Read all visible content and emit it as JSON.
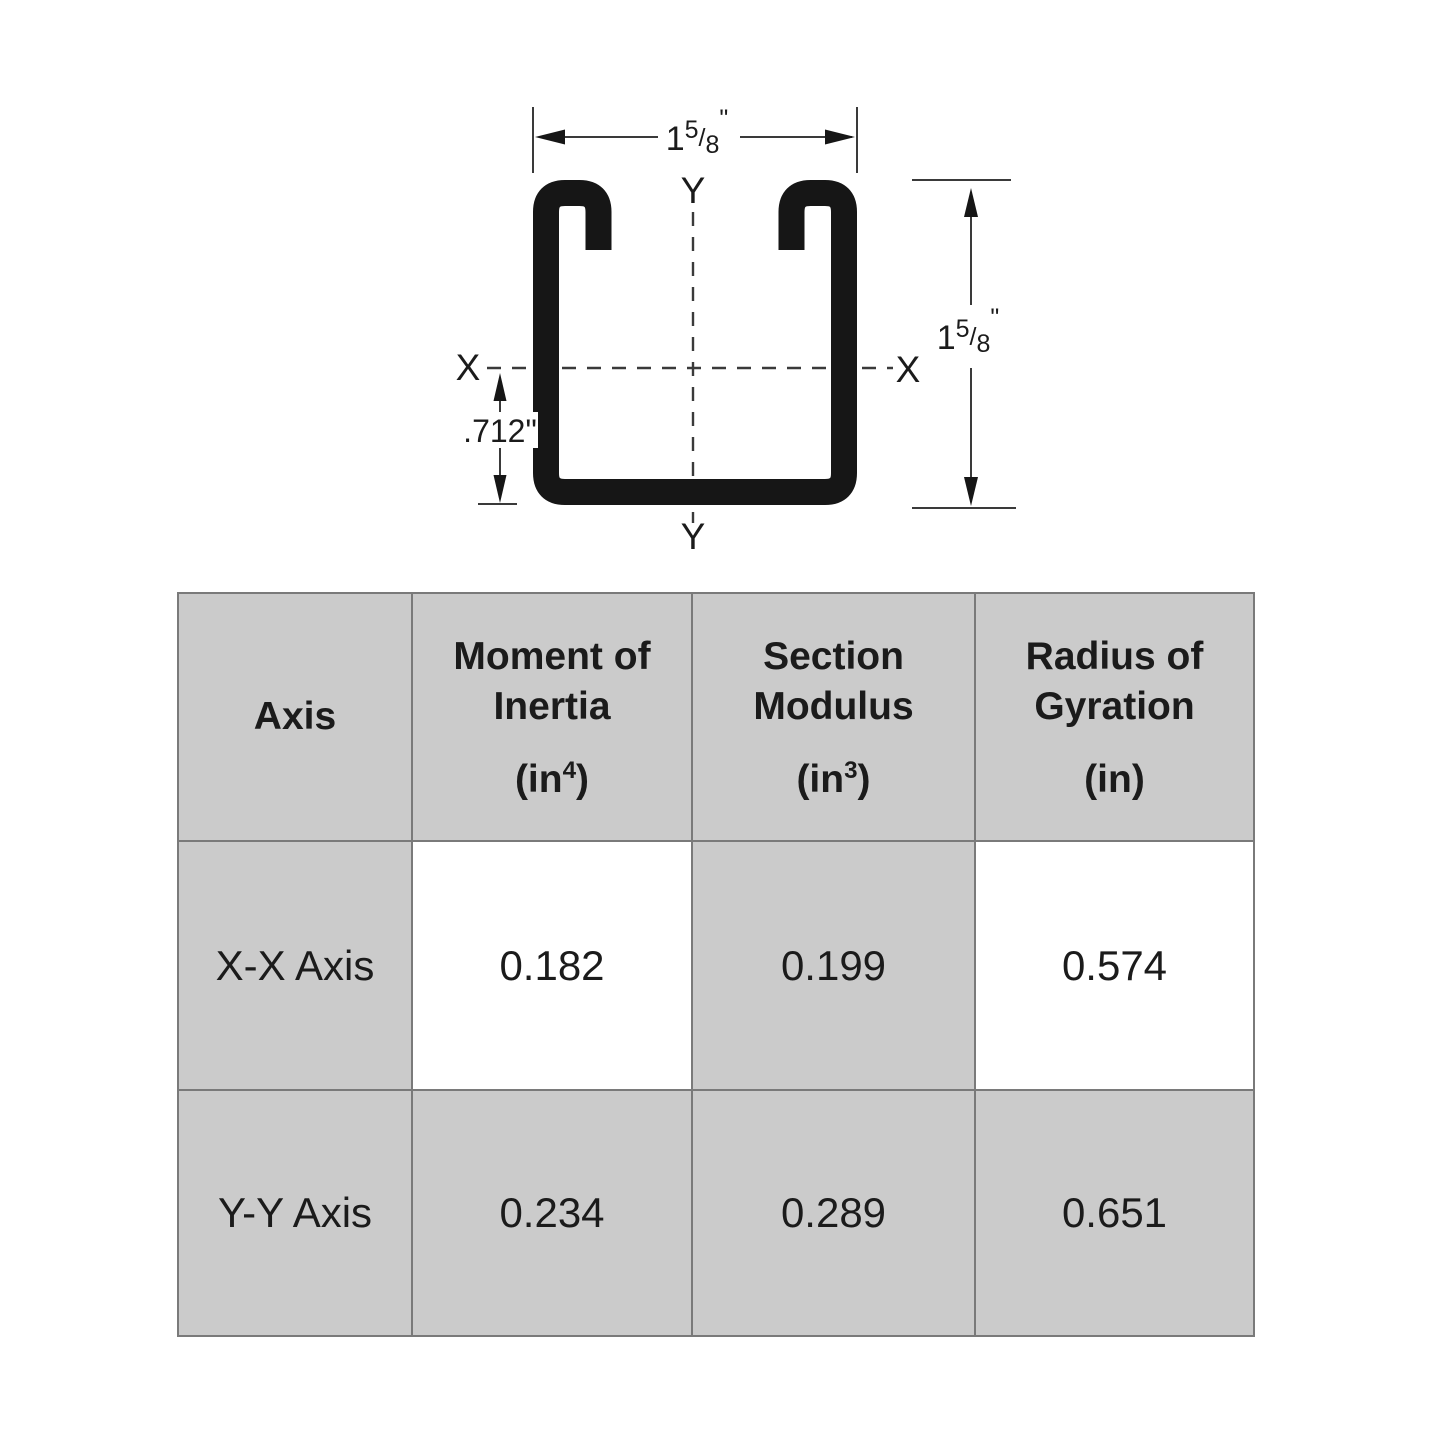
{
  "diagram": {
    "width_dim": {
      "whole": "1",
      "numerator": "5",
      "slash": "/",
      "denominator": "8",
      "unit": "\""
    },
    "height_dim": {
      "whole": "1",
      "numerator": "5",
      "slash": "/",
      "denominator": "8",
      "unit": "\""
    },
    "centroid_dim": ".712\"",
    "axis_x_left": "X",
    "axis_x_right": "X",
    "axis_y_top": "Y",
    "axis_y_bottom": "Y"
  },
  "table": {
    "headers": {
      "axis": "Axis",
      "moment": {
        "line1": "Moment of",
        "line2": "Inertia",
        "unit_open": "(in",
        "unit_sup": "4",
        "unit_close": ")"
      },
      "section": {
        "line1": "Section",
        "line2": "Modulus",
        "unit_open": "(in",
        "unit_sup": "3",
        "unit_close": ")"
      },
      "radius": {
        "line1": "Radius of",
        "line2": "Gyration",
        "unit_open": "(in",
        "unit_sup": "",
        "unit_close": ")"
      }
    },
    "rows": [
      {
        "axis": "X-X Axis",
        "moment_of_inertia": "0.182",
        "section_modulus": "0.199",
        "radius_of_gyration": "0.574"
      },
      {
        "axis": "Y-Y Axis",
        "moment_of_inertia": "0.234",
        "section_modulus": "0.289",
        "radius_of_gyration": "0.651"
      }
    ]
  },
  "colors": {
    "channel_black": "#161616",
    "dim_line": "#3a3a3a",
    "cell_gray": "#cbcbcb",
    "border_gray": "#7a7a7a",
    "text_black": "#1b1b1b"
  }
}
